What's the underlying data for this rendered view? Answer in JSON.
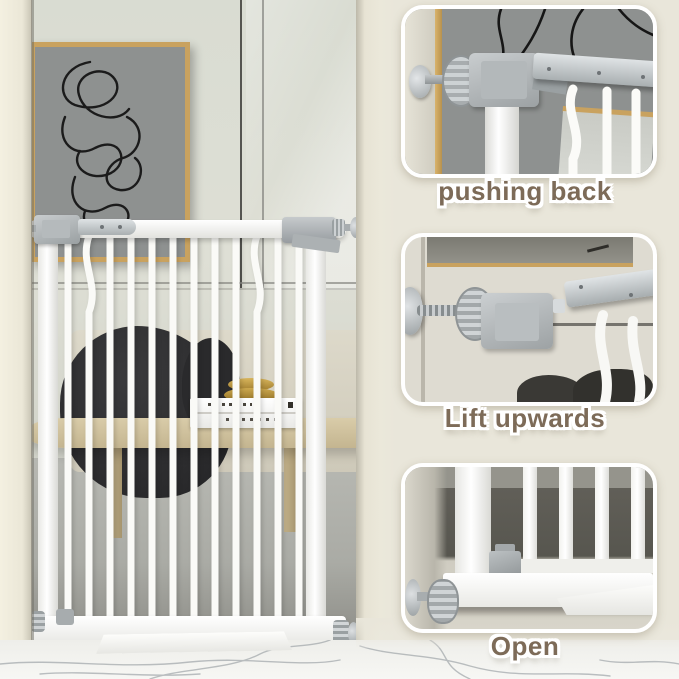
{
  "steps": [
    {
      "id": "pushing-back",
      "label": "pushing back"
    },
    {
      "id": "lift-upwards",
      "label": "Lift upwards"
    },
    {
      "id": "open",
      "label": "Open"
    }
  ],
  "colors": {
    "background": "#e9e6da",
    "caption_text": "#7d6b58",
    "caption_outline": "#ffffff",
    "gate_white": "#fbfbf9",
    "metal_gray": "#9aa0a2",
    "frame_gold": "#c9a25f",
    "art_canvas": "#8e9190",
    "blanket_dark": "#232325",
    "table_wood": "#c4b590",
    "marble_vein": "#9aa0a4"
  }
}
